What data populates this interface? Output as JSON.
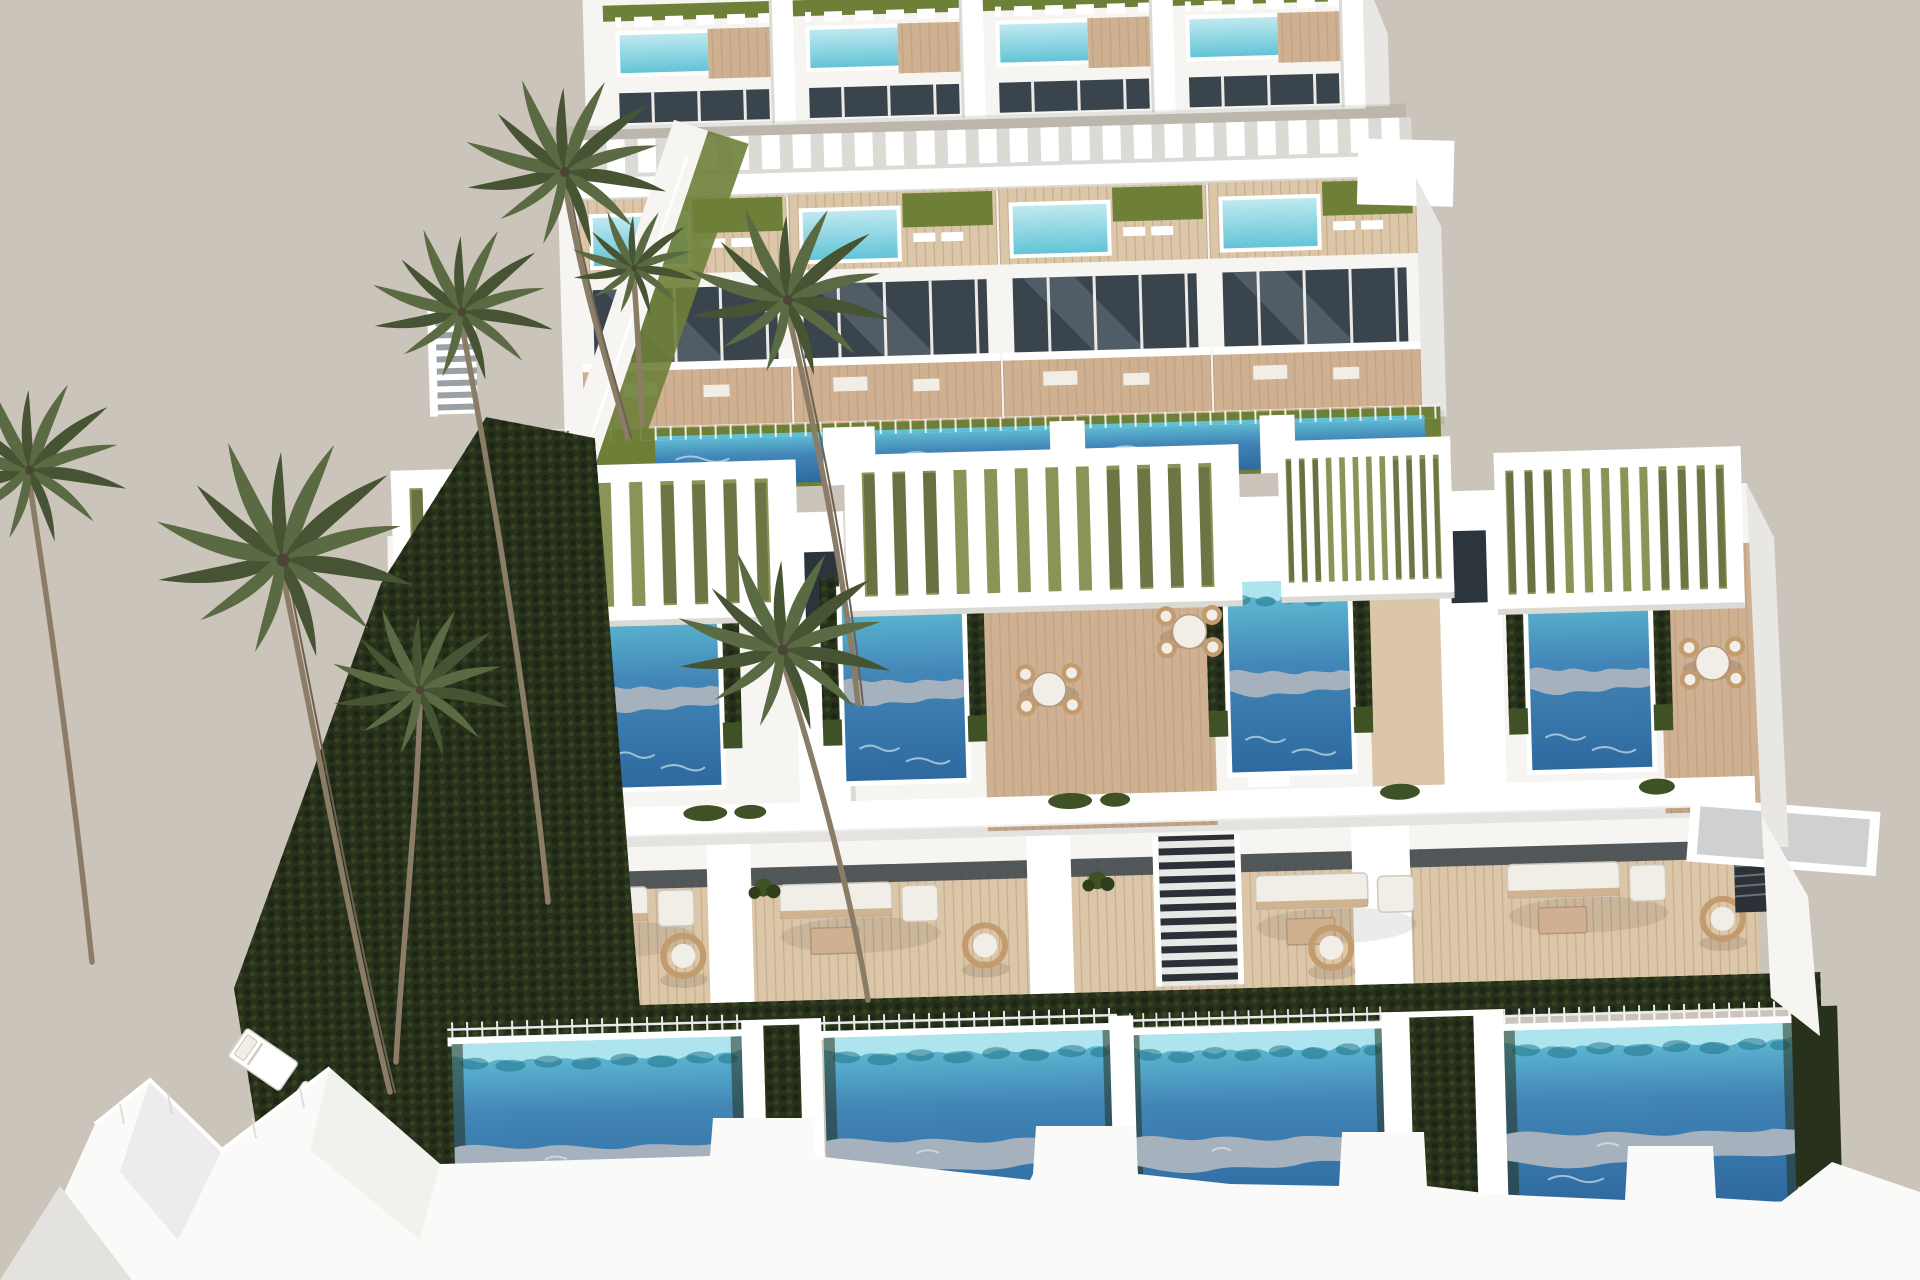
{
  "scene": {
    "description": "Aerial 3D architectural rendering of a modern white coastal villa development with three stepped rows of townhouses, turquoise rooftop plunge pools, large private blue swimming pools, slatted white pergolas, wooden sun decks, dark landscaped hedges, green lawns and tall palm trees against a plain beige background",
    "type": "architectural-render",
    "view": "elevated-aerial-perspective",
    "time_of_day": "bright daylight",
    "text_content": "none"
  },
  "palette": {
    "bg": "#cbc4ba",
    "building_white": "#f6f5f2",
    "building_bright": "#ffffff",
    "building_shadow": "#dbdad5",
    "wall_side": "#e8e7e3",
    "glass_dark": "#3a444c",
    "glass_darker": "#2c353c",
    "glass_sheen": "#6e7d88",
    "wood_deck": "#cfb191",
    "wood_light": "#dcc6a8",
    "wood_line": "#b3957a",
    "lawn_green": "#6e7f38",
    "lawn_soft": "#8a9456",
    "hedge_dark": "#27311b",
    "plant_green": "#3f5226",
    "pool_deep": "#2e699f",
    "pool_mid": "#4285b7",
    "pool_turquoise": "#63c4d7",
    "pool_light": "#bfe9f0",
    "pool_fringe": "#aee4ed",
    "pool_reflection": "#a5b1bd",
    "pool_glint": "#dcebef",
    "palm_frond": "#5a6a42",
    "palm_frond_dark": "#465434",
    "palm_trunk": "#8a7c66",
    "palm_trunk_dark": "#6d6151",
    "wicker": "#c29b6e",
    "cushion": "#f1eee8",
    "path_gray": "#70767c"
  },
  "inventory": {
    "villa_rows": 3,
    "villas_visible": 12,
    "rooftop_plunge_pools": 8,
    "terrace_pools": 4,
    "ground_pools": 4,
    "swim_lane_strips": 4,
    "pergolas": 7,
    "palm_trees": 8,
    "sun_loungers": 3,
    "dining_sets": 4,
    "outdoor_sofas": 4,
    "hanging_chairs": 4,
    "staircases": 6,
    "glass_balustrades": true,
    "hedgerows": true
  }
}
